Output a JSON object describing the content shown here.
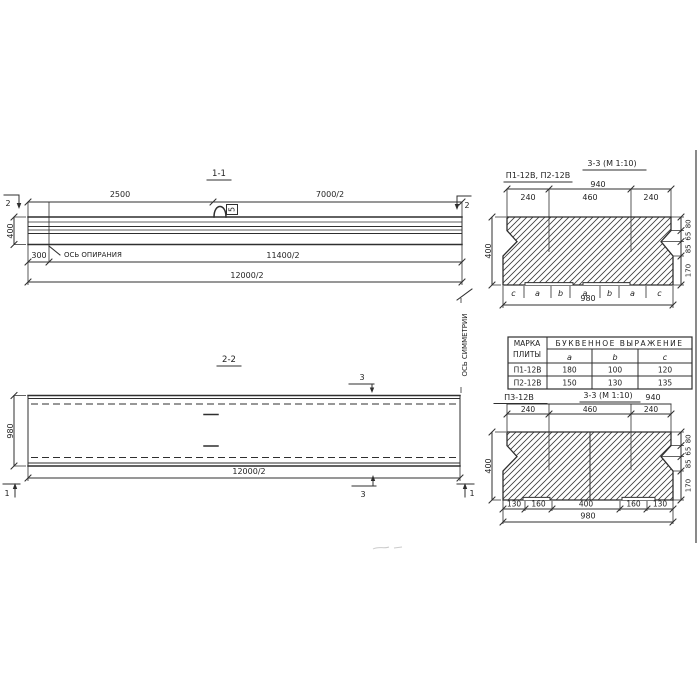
{
  "s11": {
    "title": "1-1",
    "cut_left": "2",
    "cut_right": "2",
    "dim_top_left": "2500",
    "dim_top_right": "7000/2",
    "dim_height": "400",
    "dim_offset": "300",
    "bearing_axis": "ОСЬ ОПИРАНИЯ",
    "dim_mid": "11400/2",
    "dim_full": "12000/2",
    "loop_tag": "5"
  },
  "s22": {
    "title": "2-2",
    "cut3": "3",
    "cut1": "1",
    "dim_width": "980",
    "dim_full": "12000/2",
    "symmetry_axis": "ОСЬ СИММЕТРИИ"
  },
  "s33a": {
    "plates": "П1-12В, П2-12В",
    "title": "3-3 (М 1:10)",
    "dim_940": "940",
    "top": [
      "240",
      "460",
      "240"
    ],
    "h": "400",
    "right": [
      "80",
      "65",
      "85",
      "170"
    ],
    "letters": [
      "c",
      "a",
      "b",
      "a",
      "b",
      "a",
      "c"
    ],
    "dim_980": "980"
  },
  "table": {
    "mark_header": [
      "МАРКА",
      "ПЛИТЫ"
    ],
    "group_header": "БУКВЕННОЕ ВЫРАЖЕНИЕ",
    "cols": [
      "a",
      "b",
      "c"
    ],
    "rows": [
      {
        "mark": "П1-12В",
        "a": "180",
        "b": "100",
        "c": "120"
      },
      {
        "mark": "П2-12В",
        "a": "150",
        "b": "130",
        "c": "135"
      }
    ]
  },
  "s33b": {
    "plate": "П3-12В",
    "title": "3-3 (М 1:10)",
    "dim_940": "940",
    "top": [
      "240",
      "460",
      "240"
    ],
    "h": "400",
    "right": [
      "80",
      "65",
      "85",
      "170"
    ],
    "bottom": [
      "130",
      "160",
      "400",
      "160",
      "130"
    ],
    "dim_980": "980"
  }
}
